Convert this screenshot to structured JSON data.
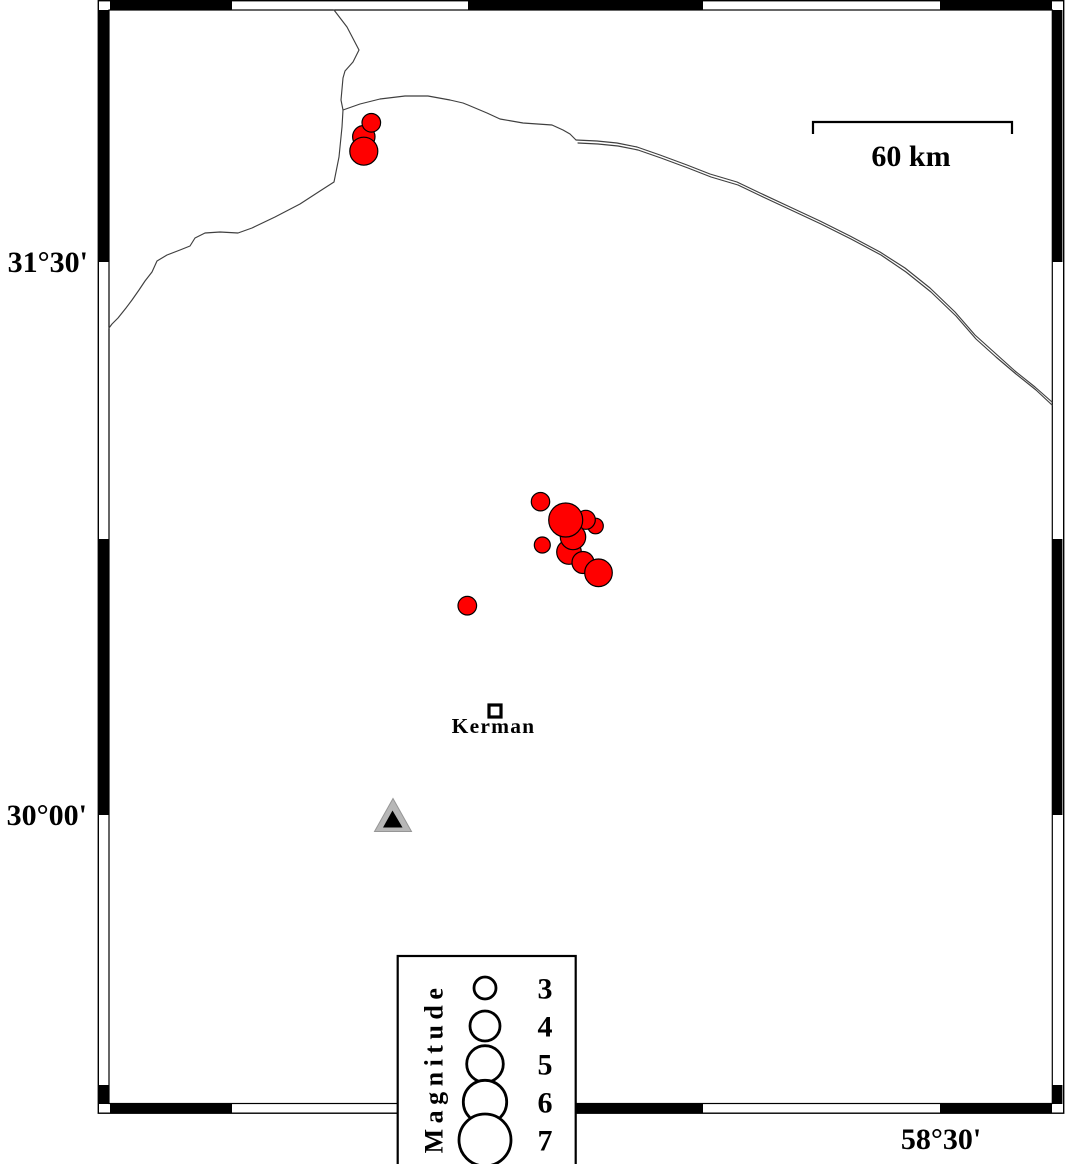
{
  "figure": {
    "type": "earthquake-epicenter-map",
    "region_labels": {
      "lat_upper": "31°30'",
      "lat_lower": "30°00'",
      "lon_bottom": "58°30'"
    },
    "scale_bar": {
      "label": "60 km"
    },
    "city": {
      "name": "Kerman"
    },
    "station": {
      "symbol": "triangle",
      "fill": "#b7b7b7",
      "inner_fill": "#000000"
    },
    "legend": {
      "title": "Magnitude",
      "entries": [
        {
          "label": "3",
          "radius": 11
        },
        {
          "label": "4",
          "radius": 15
        },
        {
          "label": "5",
          "radius": 18.3
        },
        {
          "label": "6",
          "radius": 21.7
        },
        {
          "label": "7",
          "radius": 26
        }
      ]
    },
    "colors": {
      "event_fill": "#ff0000",
      "event_stroke": "#000000",
      "boundary_line": "#3f3f3f",
      "frame": "#000000"
    },
    "earthquakes": [
      {
        "x": 595.5,
        "y": 526.0,
        "r": 7.8
      },
      {
        "x": 585.8,
        "y": 519.8,
        "r": 9.5
      },
      {
        "x": 569.0,
        "y": 552.0,
        "r": 12.3
      },
      {
        "x": 583.0,
        "y": 562.5,
        "r": 11.0
      },
      {
        "x": 598.5,
        "y": 572.8,
        "r": 13.8
      },
      {
        "x": 573.0,
        "y": 537.0,
        "r": 12.7
      },
      {
        "x": 565.7,
        "y": 520.0,
        "r": 17.0
      },
      {
        "x": 542.3,
        "y": 545.0,
        "r": 8.0
      },
      {
        "x": 540.5,
        "y": 501.7,
        "r": 9.2
      },
      {
        "x": 467.3,
        "y": 605.7,
        "r": 9.3
      },
      {
        "x": 363.8,
        "y": 136.7,
        "r": 11.2
      },
      {
        "x": 371.3,
        "y": 122.8,
        "r": 9.3
      },
      {
        "x": 363.8,
        "y": 151.2,
        "r": 14.0
      }
    ],
    "lines": {
      "boundary_west": "M 334 10 L 347 27 L 359 50 L 353 62 L 345 71 L 343 78 L 341 100 L 343 110 L 342 127 L 339 157 L 334 182 L 320 191 L 300 204 L 275 217 L 252 228 L 238 233 L 220 232 L 205 233 L 195 238 L 190 246 L 180 250 L 167 255 L 157 261 L 152 272 L 145 281 L 139 290 L 132 300 L 126 308 L 118 318 L 112 324 L 109 328",
      "boundary_main": "M 343 110 L 360 104 L 380 99 L 405 96 L 428 96 L 450 100 L 463 103 L 468 105 L 487 113 L 500 119 L 523 123 L 552 125 L 563 130 L 570 134 L 576 140",
      "road_upper": "M 576 140 L 597 141 L 617 143 L 637 147 L 660 155 L 687 165 L 710 174 L 737 182 L 760 193 L 790 207 L 820 221 L 850 236 L 880 252 L 905 268 L 930 288 L 955 312 L 975 335 L 995 353 L 1015 371 L 1035 387 L 1052 402",
      "road_lower": "M 578 143 L 598 144 L 618 146 L 638 150 L 661 158 L 688 168 L 711 177 L 738 185 L 761 196 L 791 210 L 821 224 L 851 239 L 881 255 L 906 272 L 931 292 L 956 316 L 976 339 L 996 357 L 1016 374 L 1036 390 L 1052 405"
    },
    "frame": {
      "top_black": [
        [
          110,
          232
        ],
        [
          468,
          703
        ],
        [
          940,
          1052
        ]
      ],
      "bottom_black": [
        [
          110,
          232
        ],
        [
          468,
          703
        ],
        [
          940,
          1052
        ]
      ],
      "left_black": [
        [
          10,
          262
        ],
        [
          539,
          815
        ],
        [
          1085,
          1104
        ]
      ],
      "right_black": [
        [
          10,
          262
        ],
        [
          539,
          815
        ],
        [
          1085,
          1104
        ]
      ]
    }
  }
}
